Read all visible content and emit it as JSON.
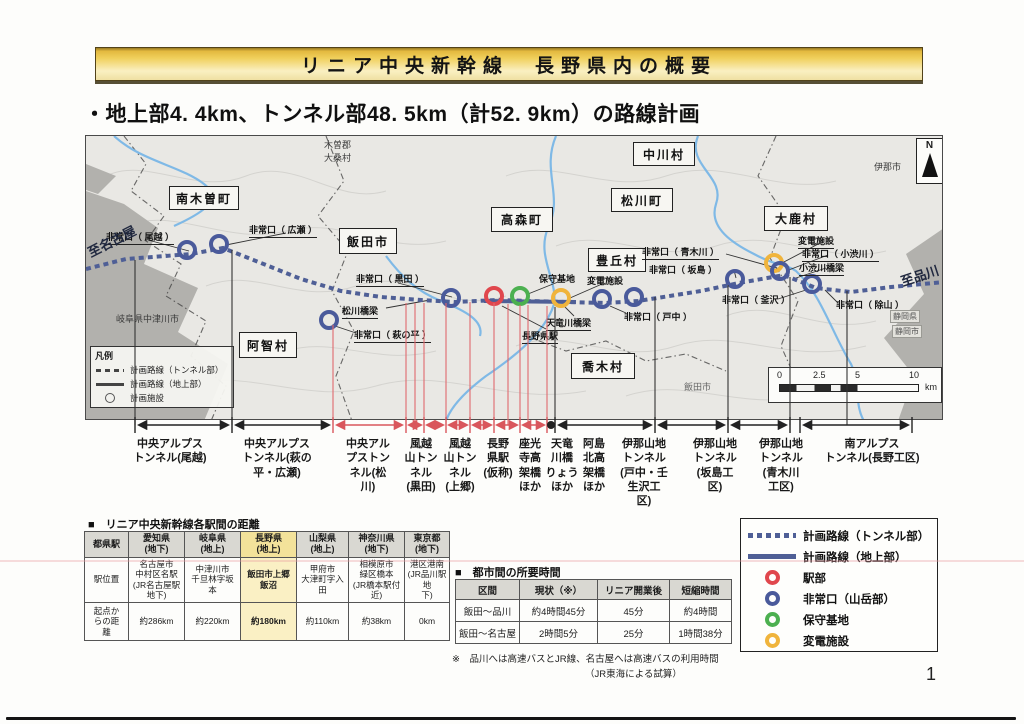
{
  "banner": {
    "title": "リニア中央新幹線　長野県内の概要"
  },
  "subtitle": "・地上部4. 4km、トンネル部48. 5km（計52. 9km）の路線計画",
  "map": {
    "towns": [
      "南木曽町",
      "飯田市",
      "高森町",
      "中川村",
      "松川町",
      "豊丘村",
      "大鹿村",
      "阿智村",
      "喬木村"
    ],
    "facilities": [
      "非常口（ 尾越 ）",
      "非常口（ 広瀬 ）",
      "非常口（ 黒田 ）",
      "松川橋梁",
      "非常口（ 萩の平 ）",
      "保守基地",
      "変電施設",
      "天竜川橋梁",
      "長野県駅",
      "非常口（ 戸中 ）",
      "非常口（ 青木川 ）",
      "非常口（ 坂島 ）",
      "変電施設",
      "非常口（ 小渋川 ）",
      "小渋川橋梁",
      "非常口（ 釜沢 ）",
      "非常口（ 除山 ）"
    ],
    "edge": {
      "to_nagoya": "至名古屋",
      "to_shinagawa": "至品川",
      "gifu": "岐阜県中津川市",
      "kiso": "木曽郡\n大桑村",
      "ina_city": "伊那市",
      "shizuoka_pref": "静岡県",
      "shizuoka_city": "静岡市",
      "iida_small": "飯田市"
    },
    "legend": {
      "title": "凡例",
      "items": [
        "計画路線（トンネル部）",
        "計画路線（地上部）",
        "計画施設"
      ]
    },
    "scale": {
      "t0": "0",
      "t1": "2.5",
      "t2": "5",
      "t3": "10",
      "unit": "km"
    },
    "north": "N"
  },
  "tunnel_labels": [
    "中央アルプス\nトンネル(尾越)",
    "中央アルプス\nトンネル(萩の\n平・広瀬)",
    "中央アル\nプストン\nネル(松\n川)",
    "風越\n山トン\nネル\n(黒田)",
    "風越\n山トン\nネル\n(上郷)",
    "長野\n県駅\n(仮称)",
    "座光\n寺高\n架橋\nほか",
    "天竜\n川橋\nりょう\nほか",
    "阿島\n北高\n架橋\nほか",
    "伊那山地\nトンネル\n(戸中・壬\n生沢工\n区)",
    "伊那山地\nトンネル\n(坂島工\n区)",
    "伊那山地\nトンネル\n(青木川\n工区)",
    "南アルプス\nトンネル(長野工区)"
  ],
  "station_table": {
    "title": "■　リニア中央新幹線各駅間の距離",
    "col0": "都県駅",
    "headers": [
      "愛知県\n(地下)",
      "岐阜県\n(地上)",
      "長野県\n(地上)",
      "山梨県\n(地上)",
      "神奈川県\n(地下)",
      "東京都\n(地下)"
    ],
    "row1_label": "駅位置",
    "row1": [
      "名古屋市\n中村区名駅\n(JR名古屋駅\n地下)",
      "中津川市\n千旦林字坂\n本",
      "飯田市上郷\n飯沼",
      "甲府市\n大津町字入\n田",
      "相模原市\n緑区橋本\n(JR橋本駅付\n近)",
      "港区港南\n(JR品川駅地\n下)"
    ],
    "row2_label": "起点か\nらの距\n離",
    "row2": [
      "約286km",
      "約220km",
      "約180km",
      "約110km",
      "約38km",
      "0km"
    ]
  },
  "time_table": {
    "title": "■　都市間の所要時間",
    "headers": [
      "区間",
      "現状（※）",
      "リニア開業後",
      "短縮時間"
    ],
    "rows": [
      [
        "飯田～品川",
        "約4時間45分",
        "45分",
        "約4時間"
      ],
      [
        "飯田～名古屋",
        "2時間5分",
        "25分",
        "1時間38分"
      ]
    ],
    "note1": "※　品川へは高速バスとJR線、名古屋へは高速バスの利用時間",
    "note2": "（JR東海による試算）"
  },
  "legend": {
    "items": [
      "計画路線（トンネル部）",
      "計画路線（地上部）",
      "駅部",
      "非常口（山岳部）",
      "保守基地",
      "変電施設"
    ]
  },
  "page": {
    "number": "1"
  },
  "colors": {
    "route": "#4f5f96",
    "connector_red": "#d9565c",
    "station_red": "#e0474d",
    "exit_blue": "#4a5a9b",
    "depot_green": "#4cb050",
    "substation_orange": "#f0b43c",
    "highlight": "#f3e29a",
    "highlight_light": "#faf0c4",
    "banner_gold": "#e9c23f"
  }
}
